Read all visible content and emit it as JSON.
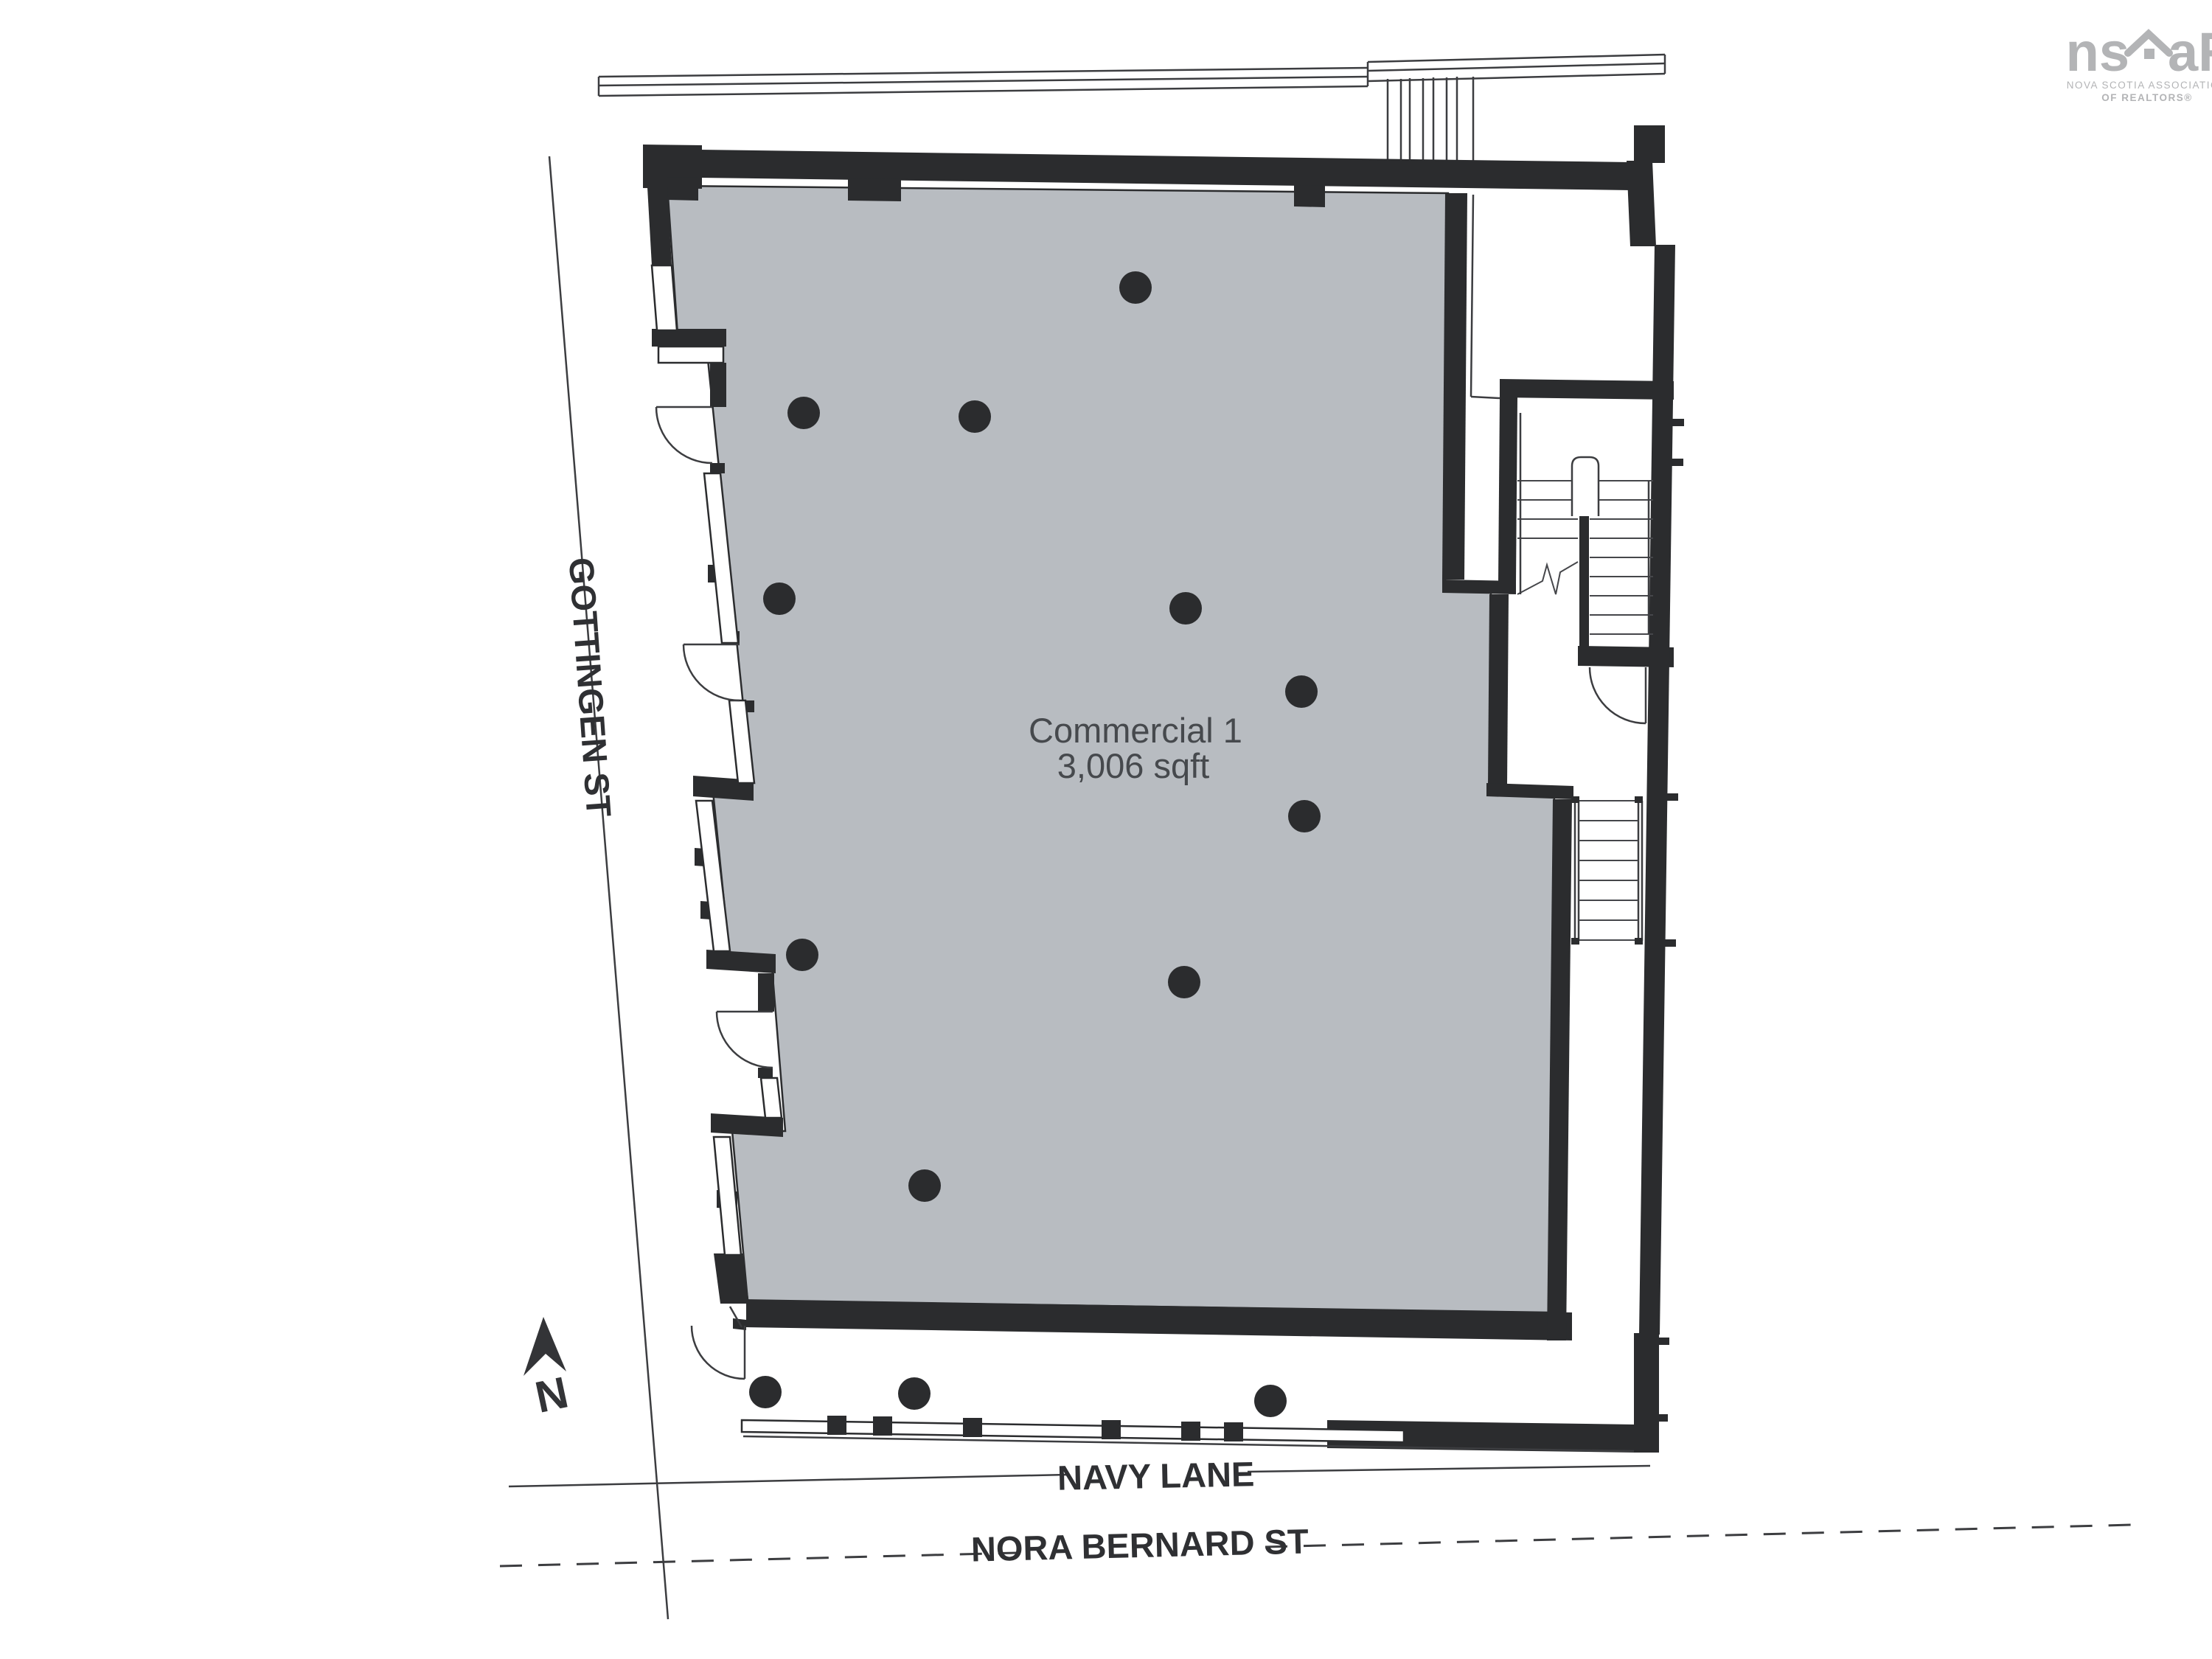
{
  "plan": {
    "unit_label": "Commercial 1",
    "unit_area": "3,006 sqft",
    "north_label": "N"
  },
  "streets": {
    "west": "GOTTINGEN ST",
    "south": "NAVY LANE",
    "south_outer": "NORA BERNARD ST"
  },
  "logo": {
    "brand_left": "ns",
    "brand_right": "aR",
    "tagline_1": "NOVA SCOTIA ASSOCIATION",
    "tagline_2": "OF REALTORS®"
  },
  "columns": {
    "radius": 22,
    "interior": [
      [
        1540,
        390
      ],
      [
        1090,
        560
      ],
      [
        1322,
        565
      ],
      [
        1057,
        812
      ],
      [
        1608,
        825
      ],
      [
        1765,
        938
      ],
      [
        1769,
        1107
      ],
      [
        1088,
        1295
      ],
      [
        1606,
        1332
      ],
      [
        1254,
        1608
      ]
    ],
    "walkway": [
      [
        1038,
        1888
      ],
      [
        1240,
        1890
      ],
      [
        1723,
        1900
      ]
    ]
  },
  "colors": {
    "wall": "#2b2c2e",
    "floor": "#b8bcc1",
    "thin_line": "#3c3d40",
    "label_text": "#2f3033",
    "unit_text": "#46494d",
    "logo_gray": "#b3b4b6"
  }
}
